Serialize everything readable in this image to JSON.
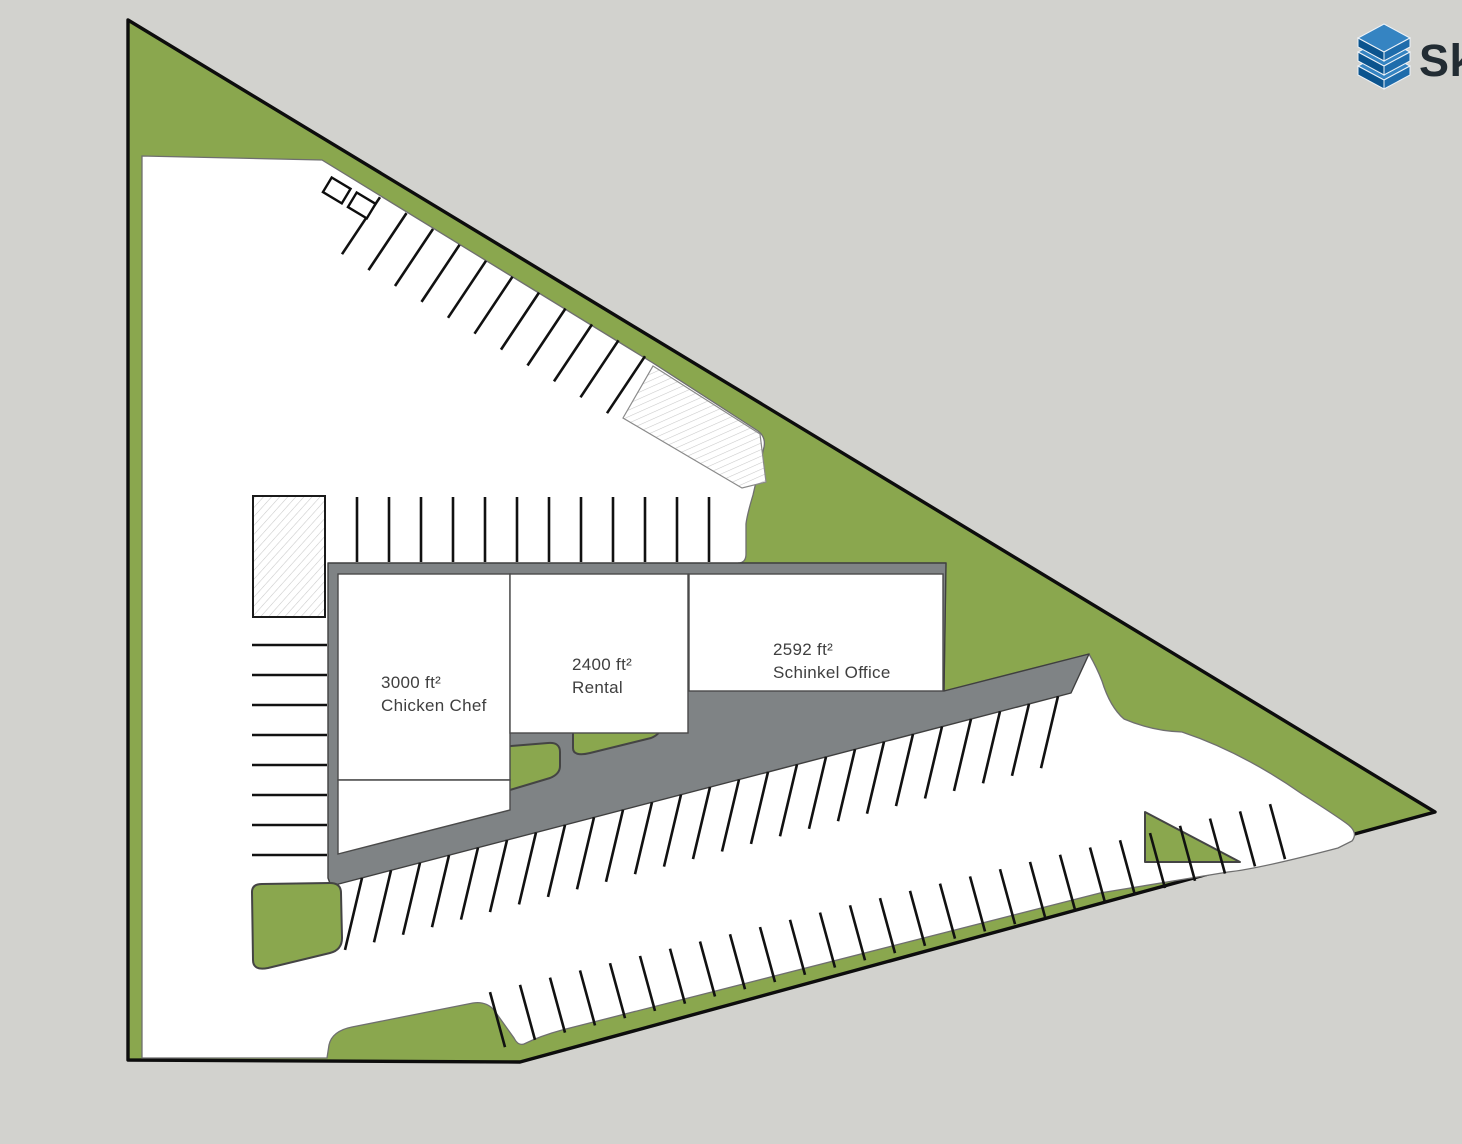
{
  "colors": {
    "background": "#d2d2ce",
    "landscape": "#8aa74e",
    "pavement": "#ffffff",
    "apron": "#7f8385",
    "outline": "#0d0d0d",
    "stall_line": "#111111",
    "label_text": "#3f3f3f",
    "logo_text": "#222c33",
    "logo_blue_dark": "#0b548e",
    "logo_blue_mid": "#1e6cab",
    "logo_blue_light": "#3584c2"
  },
  "logo": {
    "visible_text": "Sk",
    "icon": "sketchup-cube-logo"
  },
  "buildings": [
    {
      "area": "3000 ft²",
      "name": "Chicken Chef"
    },
    {
      "area": "2400 ft²",
      "name": "Rental"
    },
    {
      "area": "2592 ft²",
      "name": "Schinkel Office"
    }
  ]
}
